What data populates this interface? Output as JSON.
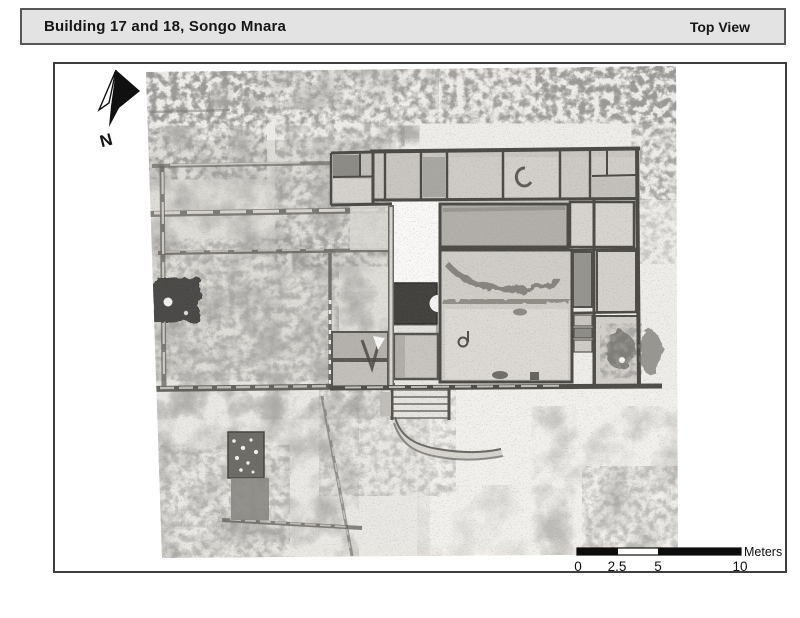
{
  "header": {
    "title": "Building 17 and 18, Songo Mnara",
    "view_label": "Top View"
  },
  "map": {
    "north_label": "N",
    "scale_bar": {
      "ticks": [
        "0",
        "2.5",
        "5",
        "10"
      ],
      "unit_label": "Meters"
    }
  },
  "colors": {
    "header_bg": "#e3e3e3",
    "header_border": "#57575a",
    "frame_border": "#3e3e40",
    "page_bg": "#ffffff",
    "scale_bar_ink": "#0d0d0d"
  }
}
